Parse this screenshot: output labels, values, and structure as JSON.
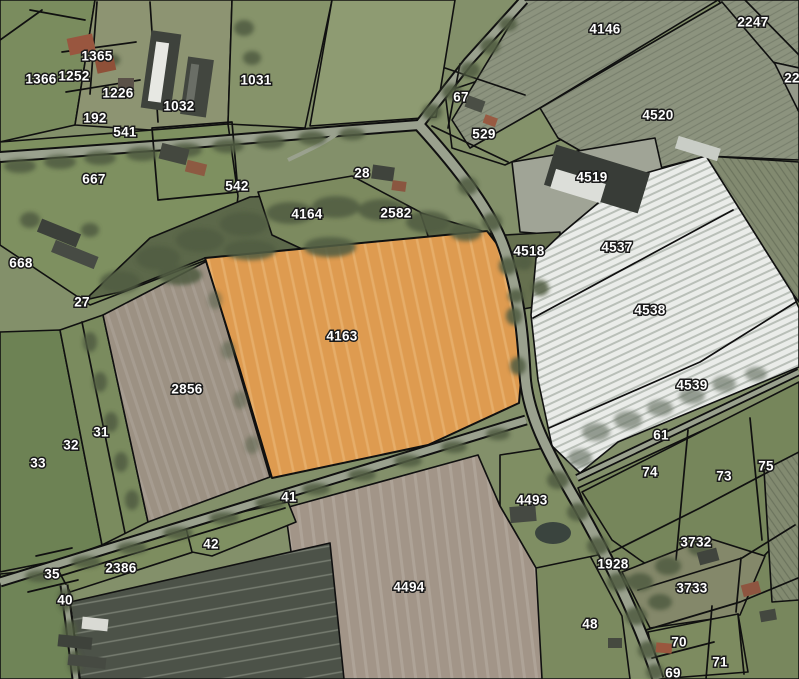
{
  "map": {
    "name": "Cadastral parcel map over aerial photo",
    "selected_parcel_id": "4163",
    "colors": {
      "highlight": "#de9b50",
      "boundary": "#101010",
      "label_fill": "#ffffff",
      "label_outline": "#1a1a1a",
      "road": "#9aa18e",
      "trees": "#515d43",
      "foil_white": "#eaece9",
      "pasture": "#7e9060",
      "plowed_brown": "#a29588",
      "dark_field": "#4c5248"
    },
    "labels": [
      {
        "t": "1365",
        "x": 97,
        "y": 57
      },
      {
        "t": "1366",
        "x": 41,
        "y": 80
      },
      {
        "t": "1252",
        "x": 74,
        "y": 77
      },
      {
        "t": "1226",
        "x": 118,
        "y": 94
      },
      {
        "t": "1032",
        "x": 179,
        "y": 107
      },
      {
        "t": "1031",
        "x": 256,
        "y": 81
      },
      {
        "t": "192",
        "x": 95,
        "y": 119
      },
      {
        "t": "541",
        "x": 125,
        "y": 133
      },
      {
        "t": "667",
        "x": 94,
        "y": 180
      },
      {
        "t": "668",
        "x": 21,
        "y": 264
      },
      {
        "t": "27",
        "x": 82,
        "y": 303
      },
      {
        "t": "542",
        "x": 237,
        "y": 187
      },
      {
        "t": "28",
        "x": 362,
        "y": 174
      },
      {
        "t": "4164",
        "x": 307,
        "y": 215
      },
      {
        "t": "2582",
        "x": 396,
        "y": 214
      },
      {
        "t": "67",
        "x": 461,
        "y": 98
      },
      {
        "t": "529",
        "x": 484,
        "y": 135
      },
      {
        "t": "4146",
        "x": 605,
        "y": 30
      },
      {
        "t": "2247",
        "x": 753,
        "y": 23
      },
      {
        "t": "22",
        "x": 792,
        "y": 79
      },
      {
        "t": "4520",
        "x": 658,
        "y": 116
      },
      {
        "t": "4519",
        "x": 592,
        "y": 178
      },
      {
        "t": "4518",
        "x": 529,
        "y": 252
      },
      {
        "t": "4537",
        "x": 617,
        "y": 248
      },
      {
        "t": "4538",
        "x": 650,
        "y": 311
      },
      {
        "t": "4539",
        "x": 692,
        "y": 386
      },
      {
        "t": "61",
        "x": 661,
        "y": 436
      },
      {
        "t": "74",
        "x": 650,
        "y": 473
      },
      {
        "t": "73",
        "x": 724,
        "y": 477
      },
      {
        "t": "75",
        "x": 766,
        "y": 467
      },
      {
        "t": "4163",
        "x": 342,
        "y": 337
      },
      {
        "t": "2856",
        "x": 187,
        "y": 390
      },
      {
        "t": "31",
        "x": 101,
        "y": 433
      },
      {
        "t": "32",
        "x": 71,
        "y": 446
      },
      {
        "t": "33",
        "x": 38,
        "y": 464
      },
      {
        "t": "41",
        "x": 289,
        "y": 498
      },
      {
        "t": "42",
        "x": 211,
        "y": 545
      },
      {
        "t": "2386",
        "x": 121,
        "y": 569
      },
      {
        "t": "35",
        "x": 52,
        "y": 575
      },
      {
        "t": "40",
        "x": 65,
        "y": 601
      },
      {
        "t": "4493",
        "x": 532,
        "y": 501
      },
      {
        "t": "4494",
        "x": 409,
        "y": 588
      },
      {
        "t": "1928",
        "x": 613,
        "y": 565
      },
      {
        "t": "3732",
        "x": 696,
        "y": 543
      },
      {
        "t": "3733",
        "x": 692,
        "y": 589
      },
      {
        "t": "48",
        "x": 590,
        "y": 625
      },
      {
        "t": "70",
        "x": 679,
        "y": 643
      },
      {
        "t": "71",
        "x": 720,
        "y": 663
      },
      {
        "t": "69",
        "x": 673,
        "y": 674
      }
    ]
  }
}
